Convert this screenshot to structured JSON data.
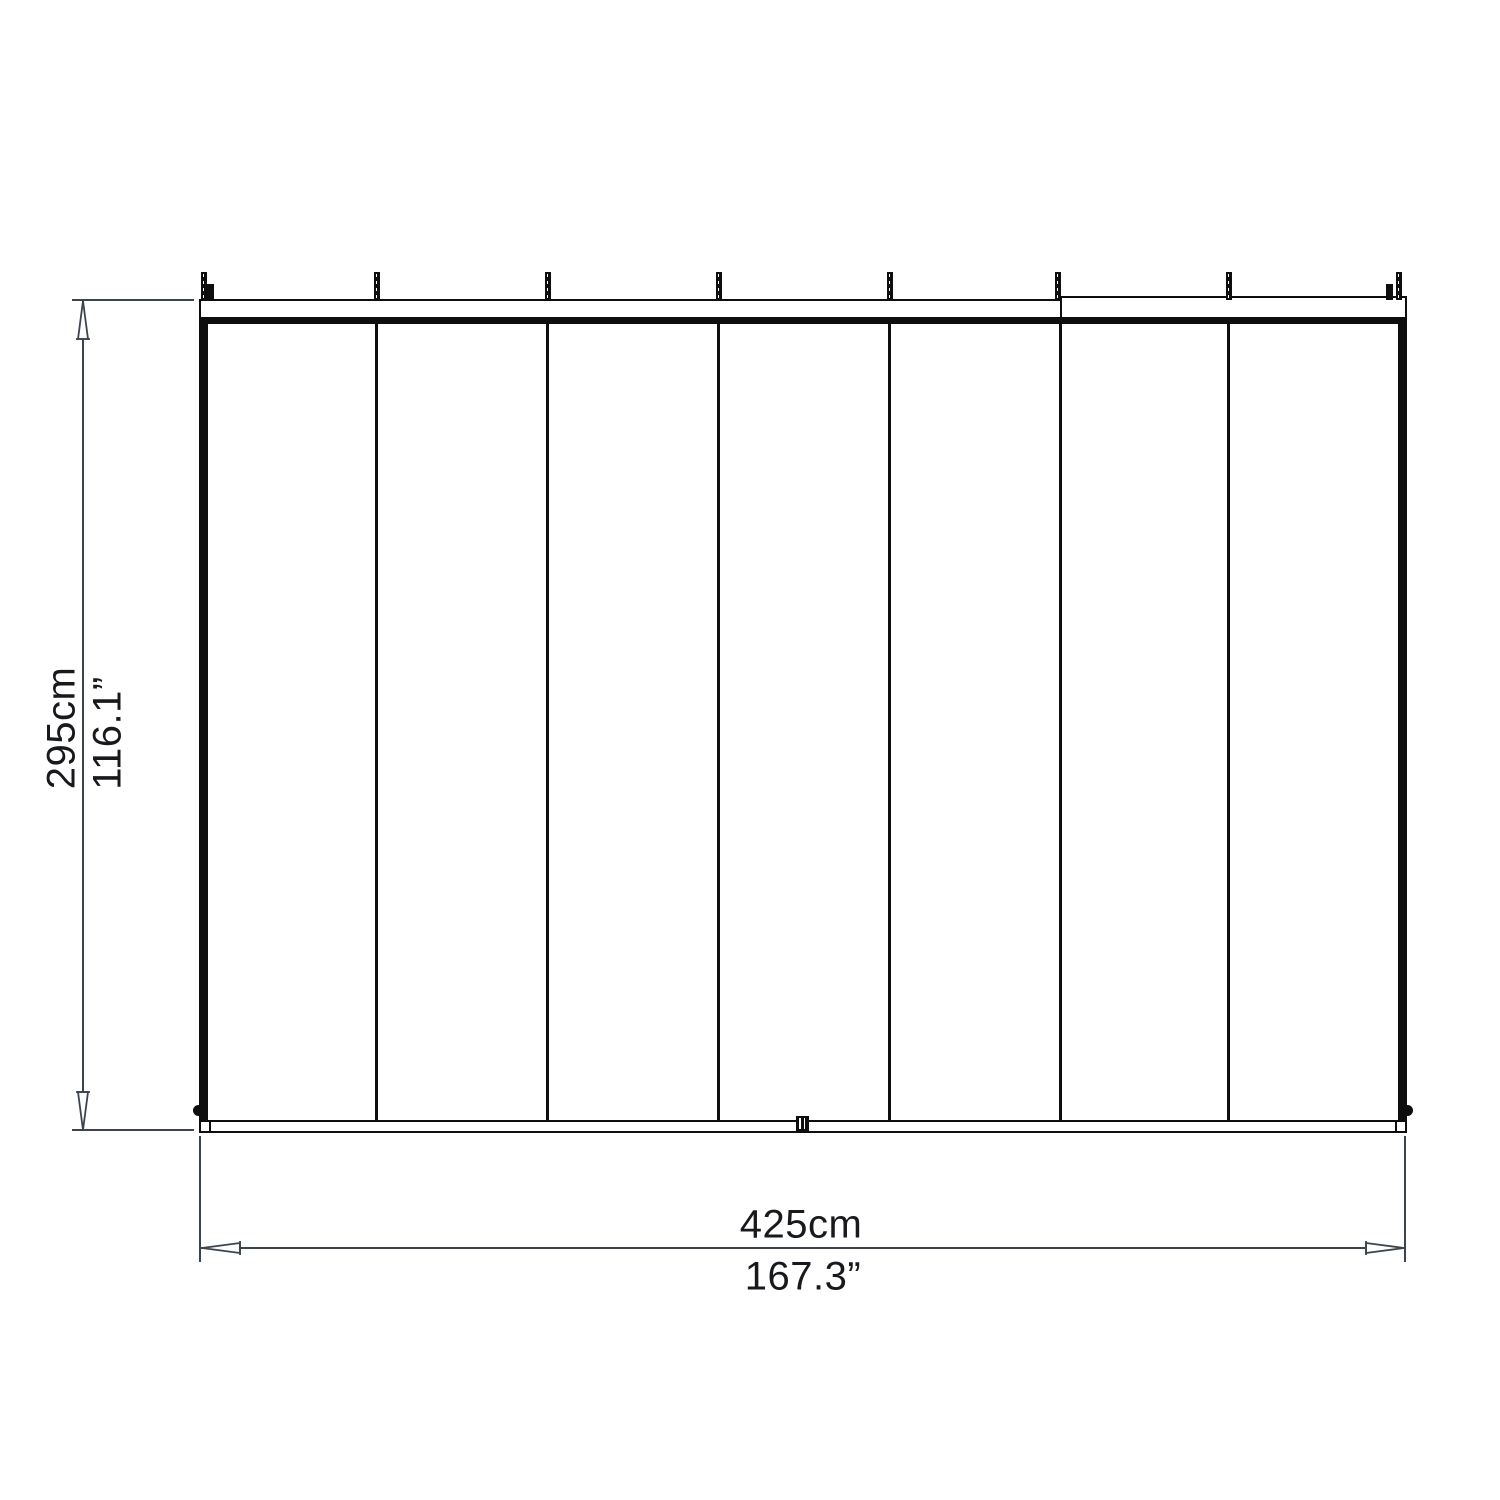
{
  "diagram": {
    "kind": "panel-structure-dimension-drawing",
    "panels": {
      "count": 7,
      "divider_count": 6,
      "peg_count": 8
    },
    "colors": {
      "background": "#ffffff",
      "outline": "#0e0e0e",
      "dimension_line": "#3c454e",
      "label_text": "#17191c"
    },
    "icons": {
      "dimension_arrow": "narrow-open-triangle-with-base-tick"
    }
  },
  "dimensions": {
    "height": {
      "metric": "295cm",
      "imperial": "116.1”"
    },
    "width": {
      "metric": "425cm",
      "imperial": "167.3”"
    }
  }
}
